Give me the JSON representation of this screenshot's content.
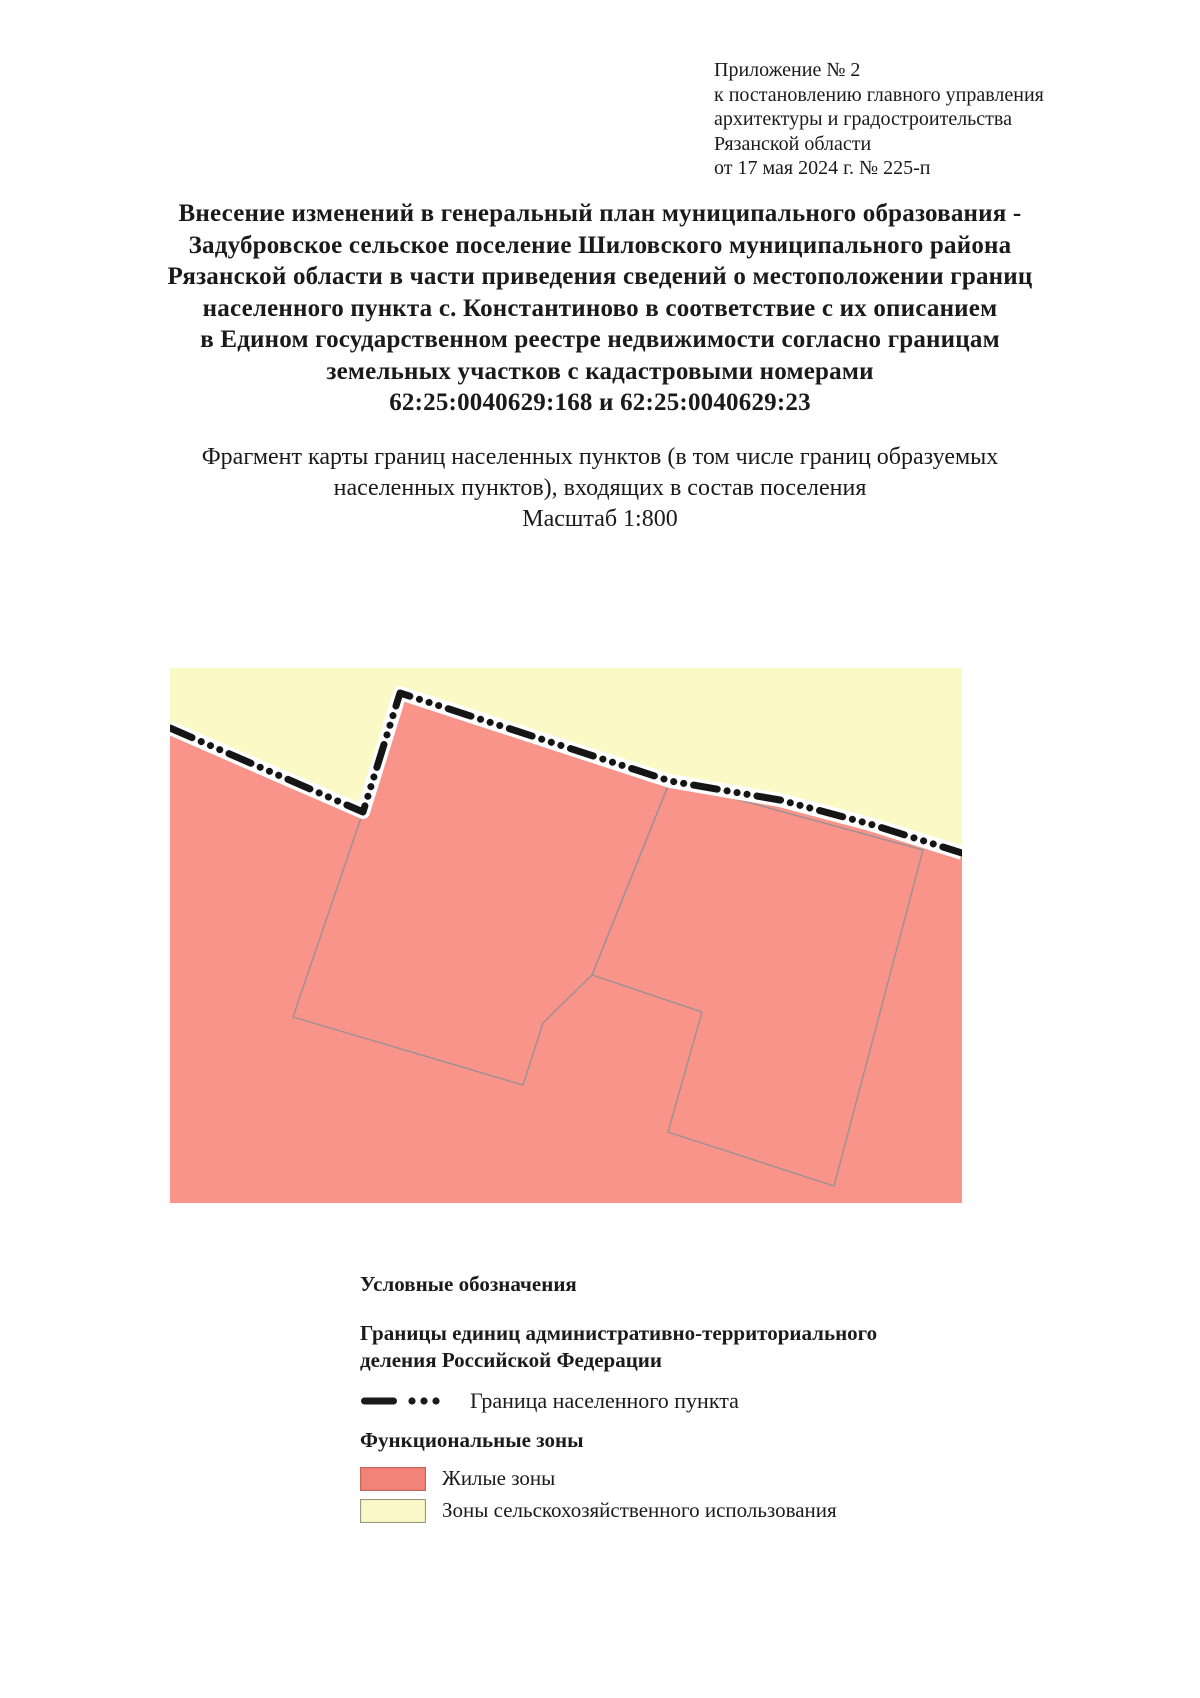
{
  "corner_block": {
    "lines": [
      "Приложение № 2",
      "к постановлению главного управления",
      "архитектуры и градостроительства",
      "Рязанской области",
      "от 17 мая 2024 г. № 225-п"
    ]
  },
  "title": {
    "lines": [
      "Внесение изменений в генеральный план муниципального образования -",
      "Задубровское сельское поселение Шиловского муниципального района",
      "Рязанской области в части приведения сведений о местоположении границ",
      "населенного пункта с. Константиново в соответствие с их описанием",
      "в Едином государственном реестре недвижимости согласно границам",
      "земельных участков с кадастровыми номерами",
      "62:25:0040629:168 и 62:25:0040629:23"
    ]
  },
  "subtitle": {
    "lines": [
      "Фрагмент карты границ населенных пунктов (в том числе границ образуемых",
      "населенных пунктов), входящих в состав поселения",
      "Масштаб 1:800"
    ]
  },
  "map": {
    "colors": {
      "agricultural": "#FBF9C6",
      "residential": "#F89489",
      "parcel_line": "#9C9095",
      "boundary": "#151515",
      "boundary_casing": "#FFFFFF"
    },
    "settlement_boundary_points": "0,60 193,144 230,25 500,113 610,132 700,156 792,185",
    "residential_polygon_points": "0,60 193,144 230,25 500,113 610,132 700,156 792,185 792,535 0,535",
    "parcels": [
      {
        "points": "193,144 230,25 500,113 422,307 373,355 353,417 123,349"
      },
      {
        "points": "500,113 753,182 664,518 498,464 532,344 422,307"
      }
    ]
  },
  "legend": {
    "title": "Условные обозначения",
    "admin_group_heading": "Границы единиц административно-территориального деления Российской Федерации",
    "boundary_symbol_color": "#1a1a1a",
    "boundary_item_label": "Граница населенного пункта",
    "zones_heading": "Функциональные зоны",
    "zone_items": [
      {
        "label": "Жилые зоны",
        "color": "#F28379",
        "border": "#C9645C"
      },
      {
        "label": "Зоны сельскохозяйственного использования",
        "color": "#FAF8C8",
        "border": "#9A9A7E"
      }
    ]
  }
}
